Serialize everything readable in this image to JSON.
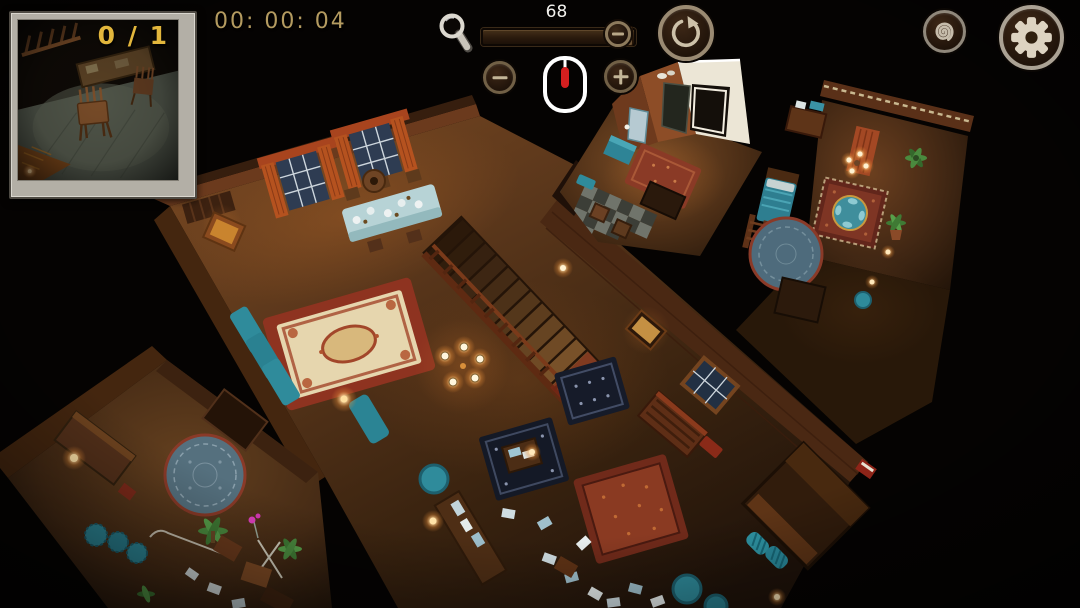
{
  "hud": {
    "objective": {
      "found": 0,
      "total": 1,
      "counter_text": "0 / 1"
    },
    "timer": {
      "text": "00: 00: 04"
    },
    "zoom_control": {
      "value": "68",
      "slider_percent": 91,
      "magnifier_icon": "magnifying-glass",
      "zoom_out_symbol": "minus",
      "zoom_in_symbol": "plus",
      "mouse_hint": "mouse-with-scroll-wheel-highlighted"
    },
    "buttons": [
      {
        "name": "reset-view",
        "icon": "circular-arrow"
      },
      {
        "name": "hint",
        "icon": "spiral"
      },
      {
        "name": "settings",
        "icon": "gear"
      }
    ],
    "colors": {
      "counter_gold": "#e2b63c",
      "timer_tan": "#b49b60",
      "zoom_value_white": "#f3f1ed",
      "mouse_wheel_red": "#d41f1f",
      "button_ring": "#9a8a72",
      "frame_silver": "#b3afa6"
    }
  },
  "minimap": {
    "counter": "0 / 1",
    "content": "framed dark photo of room with wooden chairs near a table"
  },
  "scene": {
    "description": "top-down isometric night view of wooden house interior",
    "rooms": [
      "living-room-with-staircase",
      "entrance-hall",
      "bedroom",
      "study-room"
    ],
    "colors": {
      "background": "#050302",
      "floor_wood": "#5b371b",
      "wall_wood": "#4a2813",
      "curtain_orange": "#b5521f",
      "teal_furniture": "#2f8b9b",
      "rug_red": "#8e3320",
      "rug_cream": "#e6d6ae",
      "rug_navy": "#161b29",
      "round_rug_blue": "#55707e",
      "door_light_white": "#ece6d6",
      "lamp_glow": "#ffd79a"
    }
  }
}
